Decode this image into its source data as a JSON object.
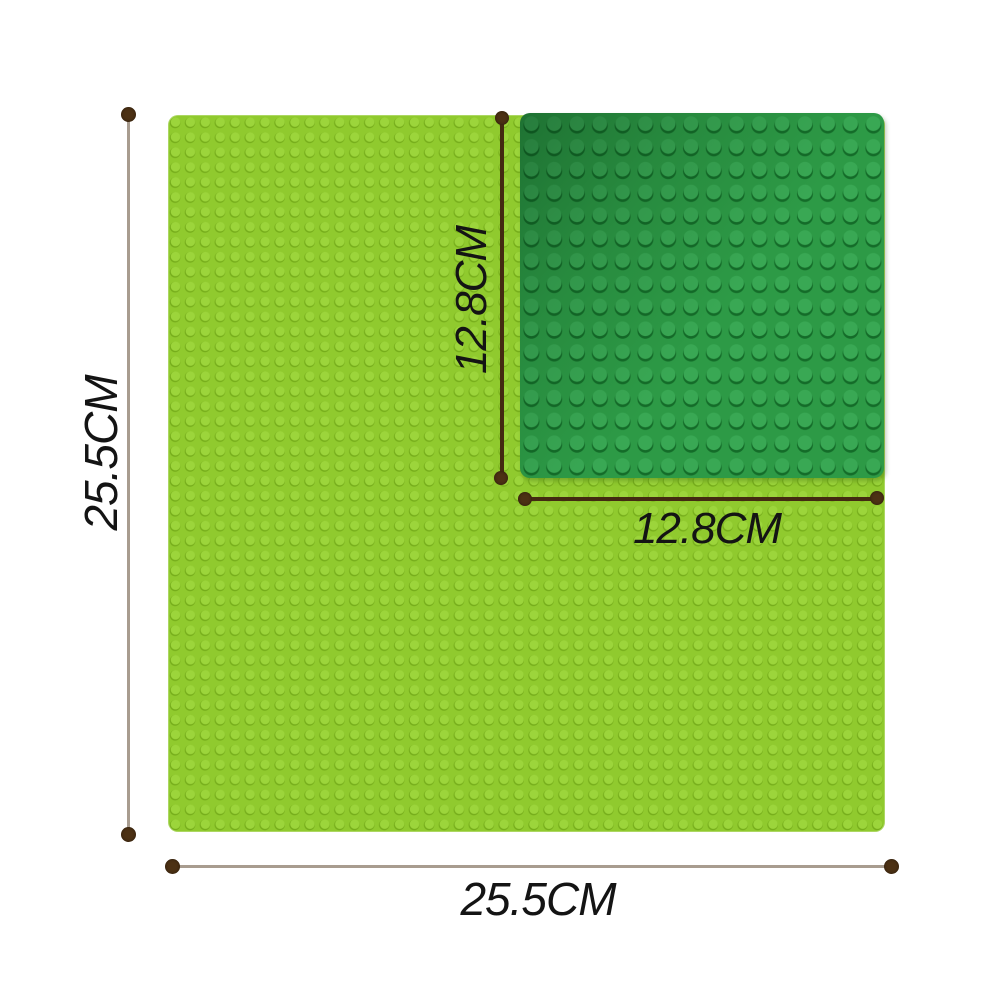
{
  "labels": {
    "large_height": "25.5CM",
    "large_width": "25.5CM",
    "small_height": "12.8CM",
    "small_width": "12.8CM"
  },
  "colors": {
    "background": "#ffffff",
    "large_plate": "#90ca2e",
    "large_plate_stud_light": "#9cd53b",
    "large_plate_stud_dark": "#76ad1b",
    "small_plate": "#2d9a46",
    "small_plate_stud_light": "#39a854",
    "small_plate_stud_dark": "#146c29",
    "outer_line": "#a89c8f",
    "inner_line": "#432a11",
    "dot": "#4c3114",
    "label": "#141414"
  }
}
